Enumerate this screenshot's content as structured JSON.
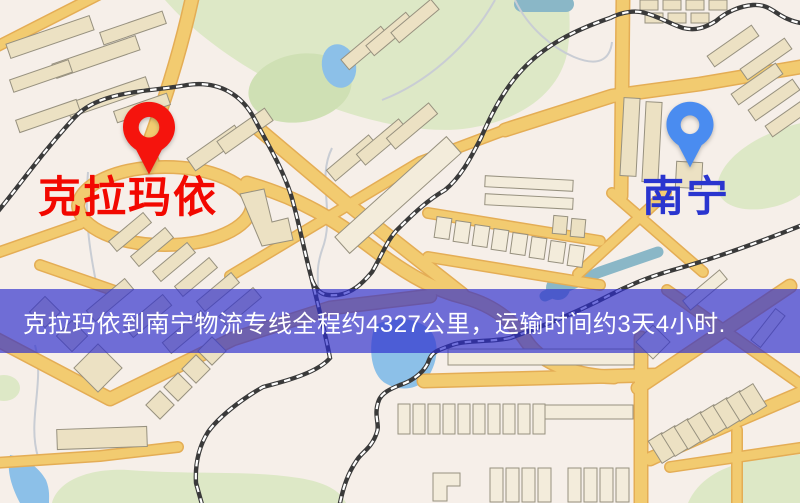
{
  "pins": {
    "origin": {
      "label": "克拉玛依",
      "icon": "map-pin-icon"
    },
    "destination": {
      "label": "南宁",
      "icon": "map-pin-icon"
    }
  },
  "banner": {
    "text": "克拉玛依到南宁物流专线全程约4327公里，运输时间约3天4小时."
  },
  "colors": {
    "bg": "#f6efe9",
    "road": "#f2cb70",
    "roadCasing": "#e4ad55",
    "building": "#ece1c3",
    "buildingLight": "#f3ecdb",
    "buildingOutline": "#97917f",
    "park": "#dde8c6",
    "parkDark": "#cfe0b4",
    "water": "#8cc0e8",
    "waterTeal": "#8ab7c7",
    "rail": "#3a3a3a",
    "railDash": "#ffffff",
    "trail": "#c9cdd4",
    "originPin": "#f5140d",
    "originLabel": "#f20800",
    "destPin": "#4a8cf0",
    "destLabel": "#2a35cf",
    "bannerBg": "rgba(45,45,205,0.67)",
    "bannerText": "#ffffff"
  }
}
